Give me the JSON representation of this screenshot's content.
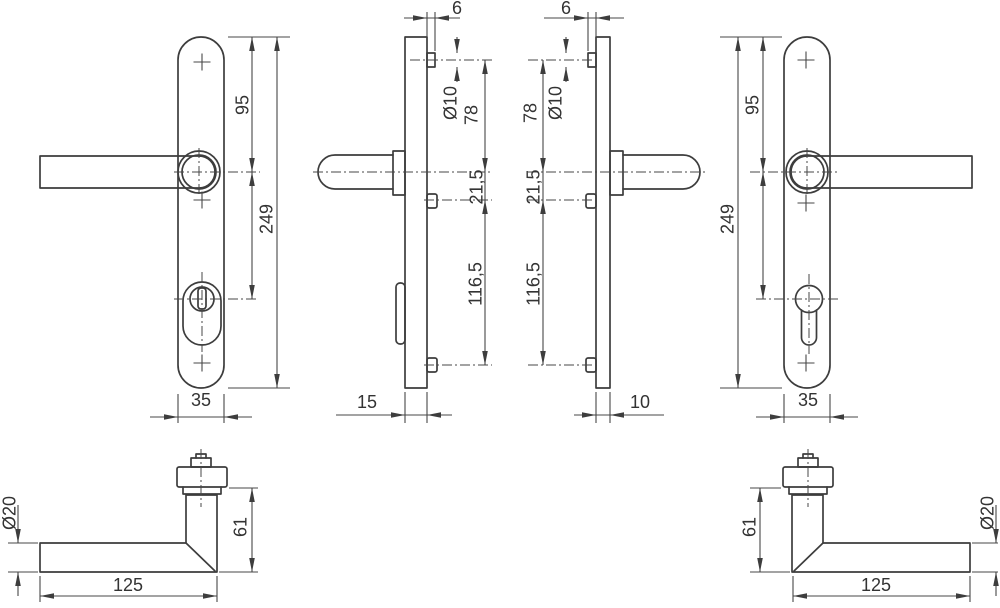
{
  "drawing": {
    "type": "technical-dimension-drawing",
    "subject": "door-handle-backplate-set",
    "colors": {
      "line": "#3d3d3d",
      "dimension": "#474747",
      "text": "#333333",
      "background": "#ffffff"
    },
    "views": {
      "left_plate_front": {
        "dim_95": "95",
        "dim_249": "249",
        "dim_35": "35"
      },
      "left_plate_side": {
        "dim_6": "6",
        "dim_d10": "Ø10",
        "dim_78": "78",
        "dim_21_5": "21,5",
        "dim_116_5": "116,5",
        "dim_15": "15"
      },
      "right_plate_side": {
        "dim_6": "6",
        "dim_d10": "Ø10",
        "dim_78": "78",
        "dim_21_5": "21,5",
        "dim_116_5": "116,5",
        "dim_10": "10"
      },
      "right_plate_front": {
        "dim_95": "95",
        "dim_249": "249",
        "dim_35": "35"
      },
      "left_handle": {
        "dim_d20": "Ø20",
        "dim_61": "61",
        "dim_125": "125"
      },
      "right_handle": {
        "dim_61": "61",
        "dim_d20": "Ø20",
        "dim_125": "125"
      }
    }
  }
}
